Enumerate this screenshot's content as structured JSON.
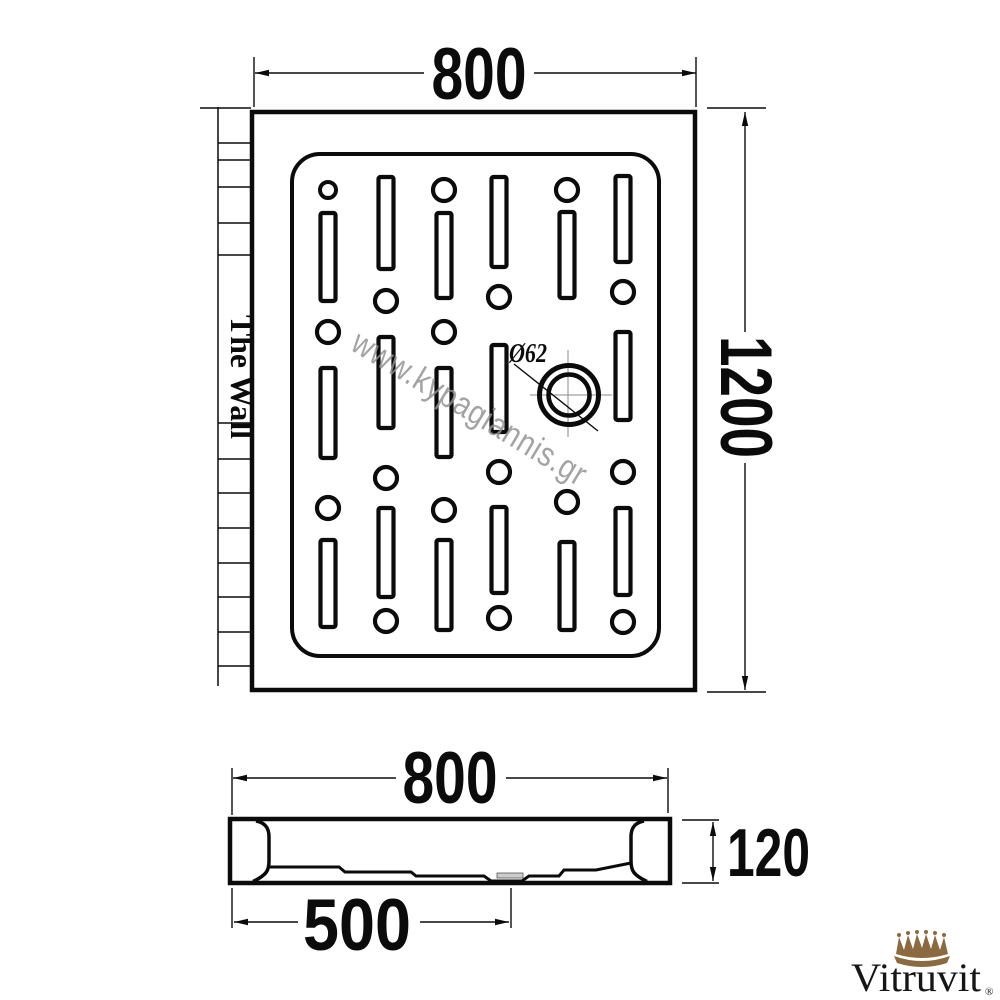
{
  "page": {
    "background": "#ffffff",
    "line_color": "#0b0b0b"
  },
  "watermark": {
    "text": "www.kypagiannis.gr",
    "color": "#8f8f8f"
  },
  "top_view": {
    "wall_label": "The Wall",
    "dim_width": "800",
    "dim_height": "1200",
    "drain_label": "Ø62"
  },
  "side_view": {
    "dim_width": "800",
    "dim_depth": "120",
    "dim_drain_offset": "500"
  },
  "logo": {
    "brand": "Vitruvit",
    "registered": "®",
    "crown_color": "#8a6a3e"
  }
}
